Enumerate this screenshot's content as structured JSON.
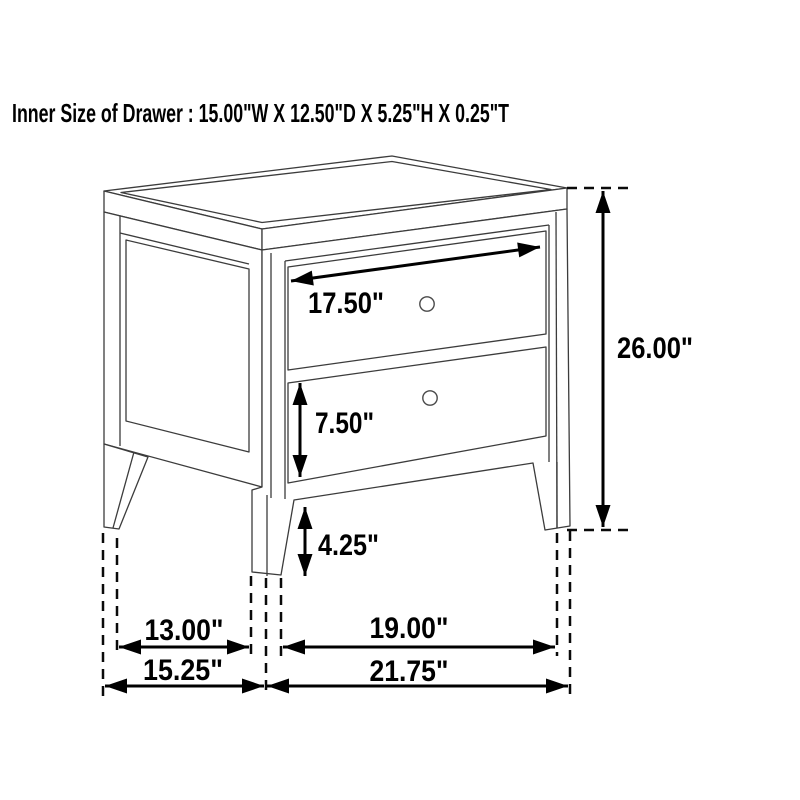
{
  "title": "Inner Size of Drawer : 15.00\"W X 12.50\"D X 5.25\"H X 0.25\"T",
  "diagram": {
    "subject": "two-drawer nightstand dimension drawing",
    "inner_drawer_size": {
      "width": "15.00\"W",
      "depth": "12.50\"D",
      "height": "5.25\"H",
      "thickness": "0.25\"T"
    },
    "dims": {
      "drawer_front_width": "17.50\"",
      "overall_height": "26.00\"",
      "bottom_drawer_height": "7.50\"",
      "leg_clearance": "4.25\"",
      "side_inner_span": "13.00\"",
      "side_overall_depth": "15.25\"",
      "front_inner_span": "19.00\"",
      "front_overall_width": "21.75\""
    },
    "colors": {
      "background": "#ffffff",
      "furniture_line": "#3c3c3c",
      "dimension_line": "#000000",
      "text": "#000000"
    }
  }
}
